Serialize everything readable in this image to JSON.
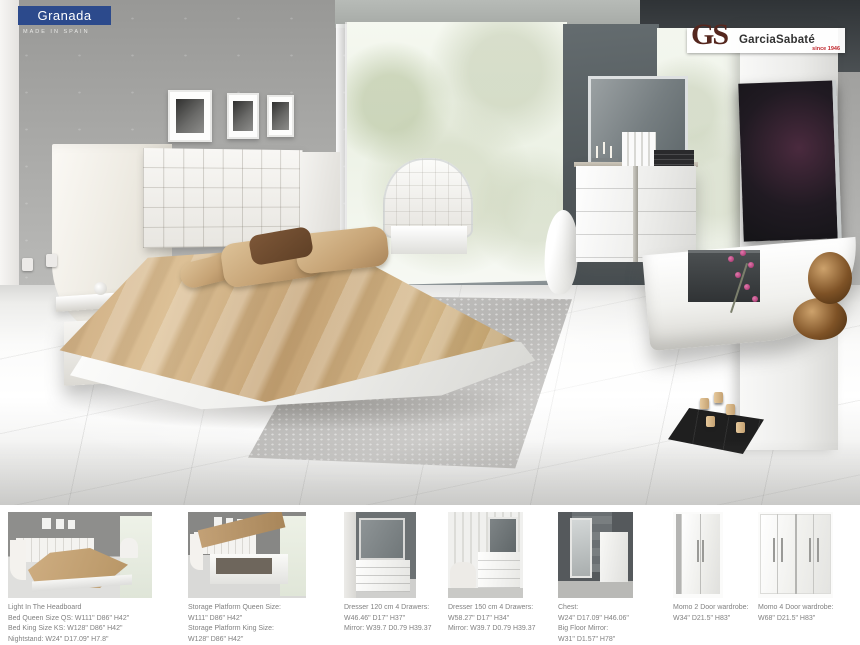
{
  "badge": {
    "title": "Granada",
    "origin": "MADE IN SPAIN",
    "color": "#2c4a8c"
  },
  "logo": {
    "initials": "GS",
    "brand": "GarciaSabaté",
    "since": "since 1946",
    "initials_color": "#55271e",
    "since_color": "#c1272d"
  },
  "palette": {
    "wall_gray": "#a9a9a7",
    "bed_tan": "#c8a377",
    "floor_white": "#fbfbfa",
    "caption_gray": "#818181"
  },
  "products": [
    {
      "id": "bed-light-headboard",
      "caption": [
        "Light In The Headboard",
        "Bed Queen Size QS: W111\" D86\" H42\"",
        "Bed King Size KS: W128\" D86\" H42\"",
        "Nightstand: W24\" D17.09\" H7.8\""
      ]
    },
    {
      "id": "storage-platform-bed",
      "caption": [
        "Storage Platform Queen Size:",
        "W111\" D86\" H42\"",
        "Storage Platform King Size:",
        "W128\" D86\" H42\""
      ]
    },
    {
      "id": "dresser-120-mirror",
      "caption": [
        "Dresser 120 cm 4 Drawers:",
        "W46.46\" D17\" H37\"",
        "Mirror: W39.7 D0.79 H39.37"
      ]
    },
    {
      "id": "dresser-150-mirror",
      "caption": [
        "Dresser 150 cm 4 Drawers:",
        "W58.27\" D17\" H34\"",
        "Mirror: W39.7 D0.79 H39.37"
      ]
    },
    {
      "id": "chest-floor-mirror",
      "caption": [
        "Chest:",
        "W24\" D17.09\" H46.06\"",
        "Big Floor Mirror:",
        "W31\" D1.57\" H78\""
      ]
    },
    {
      "id": "momo-2-door-wardrobe",
      "caption": [
        "Momo 2 Door wardrobe:",
        "W34\" D21.5\" H83\""
      ]
    },
    {
      "id": "momo-4-door-wardrobe",
      "caption": [
        "Momo 4 Door wardrobe:",
        "W68\" D21.5\" H83\""
      ]
    }
  ]
}
